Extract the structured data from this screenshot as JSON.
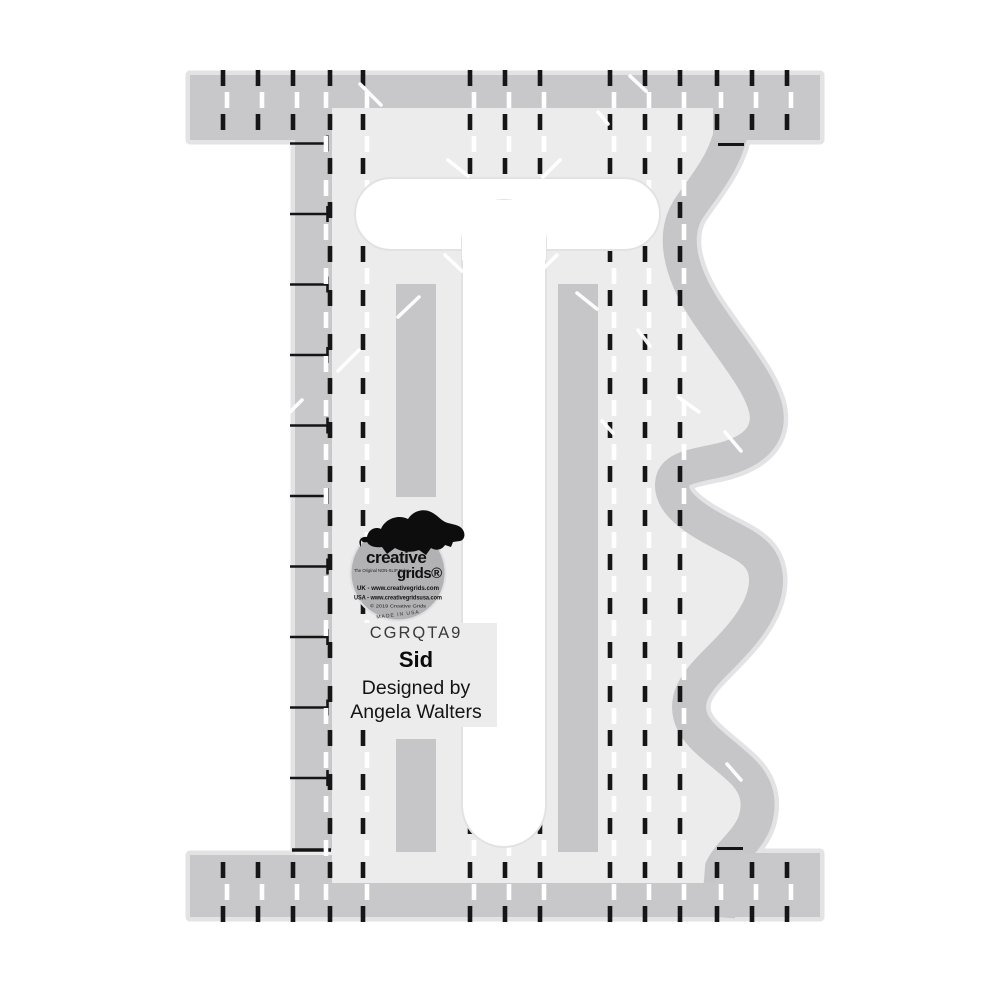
{
  "product": {
    "sku": "CGRQTA9",
    "name": "Sid",
    "designed_by": "Designed by",
    "designer": "Angela Walters"
  },
  "logo": {
    "brand_top": "creative",
    "brand_bottom": "grids®",
    "tagline": "The Original NON-SLIP Ruler",
    "line_uk": "UK - www.creativegrids.com",
    "line_usa": "USA - www.creativegridsusa.com",
    "copyright": "© 2019 Creative Grids",
    "made_in": "MADE IN USA"
  },
  "colors": {
    "background": "#ffffff",
    "ruler_body": "#ececed",
    "ruler_dark_gray": "#c8c8ca",
    "wave_band": "#c6c6c8",
    "pale_edge": "#e3e3e5",
    "marking_black": "#161616",
    "marking_white": "#ffffff",
    "sticker_gray": "#b2b2b4"
  }
}
